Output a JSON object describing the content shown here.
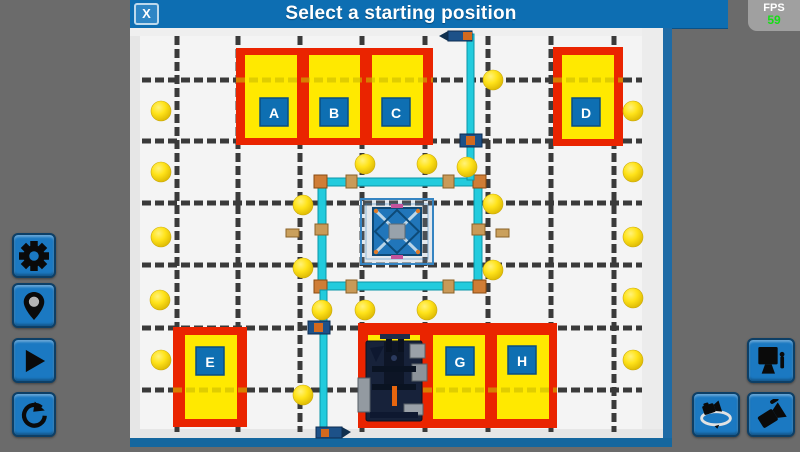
{
  "header": {
    "title": "Select a starting position",
    "close_label": "X"
  },
  "fps": {
    "label": "FPS",
    "value": "59"
  },
  "left_toolbar": {
    "buttons": [
      {
        "name": "settings",
        "icon": "gear-icon"
      },
      {
        "name": "set-position",
        "icon": "location-pin-icon"
      },
      {
        "name": "play",
        "icon": "play-icon"
      },
      {
        "name": "reset",
        "icon": "reset-rotate-icon"
      }
    ]
  },
  "right_toolbar": {
    "buttons": [
      {
        "name": "screen-view",
        "icon": "monitor-joystick-icon"
      },
      {
        "name": "orbit-camera",
        "icon": "orbit-camera-icon"
      },
      {
        "name": "free-camera",
        "icon": "tilted-camera-icon"
      }
    ]
  },
  "theme": {
    "titlebar_blue": "#0d6eb2",
    "button_blue": "#1b79c2",
    "background_gray": "#6b6b6b",
    "fps_green": "#17dd17"
  },
  "field": {
    "colors": {
      "zone_red": "#ea2400",
      "zone_yellow": "#ffe900",
      "label_blue": "#0e6fb2",
      "ball_yellow": "#f5d800",
      "structure_cyan": "#22cbdd",
      "wall_blue": "#1e6ba6"
    },
    "grid": {
      "vertical_x": [
        47,
        108,
        170,
        232,
        295,
        358,
        421,
        484
      ],
      "horizontal_y": [
        52,
        113,
        175,
        237,
        300,
        362
      ]
    },
    "red_zones": [
      [
        106,
        20,
        197,
        97
      ],
      [
        423,
        19,
        70,
        99
      ],
      [
        43,
        299,
        74,
        100
      ],
      [
        228,
        295,
        199,
        105
      ]
    ],
    "start_positions": [
      {
        "label": "A",
        "box": [
          115,
          27,
          52,
          83
        ],
        "label_cx": 144,
        "label_cy": 84
      },
      {
        "label": "B",
        "box": [
          179,
          27,
          51,
          83
        ],
        "label_cx": 204,
        "label_cy": 84
      },
      {
        "label": "C",
        "box": [
          242,
          27,
          51,
          83
        ],
        "label_cx": 266,
        "label_cy": 84
      },
      {
        "label": "D",
        "box": [
          432,
          27,
          52,
          84
        ],
        "label_cx": 456,
        "label_cy": 84
      },
      {
        "label": "E",
        "box": [
          55,
          307,
          52,
          84
        ],
        "label_cx": 80,
        "label_cy": 333
      },
      {
        "label": "",
        "box": [
          238,
          307,
          52,
          84
        ]
      },
      {
        "label": "G",
        "box": [
          303,
          307,
          52,
          84
        ],
        "label_cx": 330,
        "label_cy": 333
      },
      {
        "label": "H",
        "box": [
          367,
          307,
          52,
          84
        ],
        "label_cx": 392,
        "label_cy": 332
      }
    ],
    "seams": [
      {
        "y": 52,
        "spans": [
          [
            106,
            303
          ],
          [
            423,
            493
          ]
        ]
      },
      {
        "y": 362,
        "spans": [
          [
            43,
            117
          ],
          [
            228,
            427
          ]
        ]
      }
    ],
    "balls": [
      [
        31,
        83
      ],
      [
        31,
        144
      ],
      [
        31,
        209
      ],
      [
        30,
        272
      ],
      [
        31,
        332
      ],
      [
        503,
        83
      ],
      [
        503,
        144
      ],
      [
        503,
        209
      ],
      [
        503,
        270
      ],
      [
        503,
        332
      ],
      [
        235,
        136
      ],
      [
        297,
        136
      ],
      [
        337,
        139
      ],
      [
        363,
        52
      ],
      [
        173,
        177
      ],
      [
        173,
        240
      ],
      [
        363,
        176
      ],
      [
        363,
        242
      ],
      [
        235,
        282
      ],
      [
        297,
        282
      ],
      [
        192,
        282
      ],
      [
        173,
        367
      ]
    ]
  }
}
